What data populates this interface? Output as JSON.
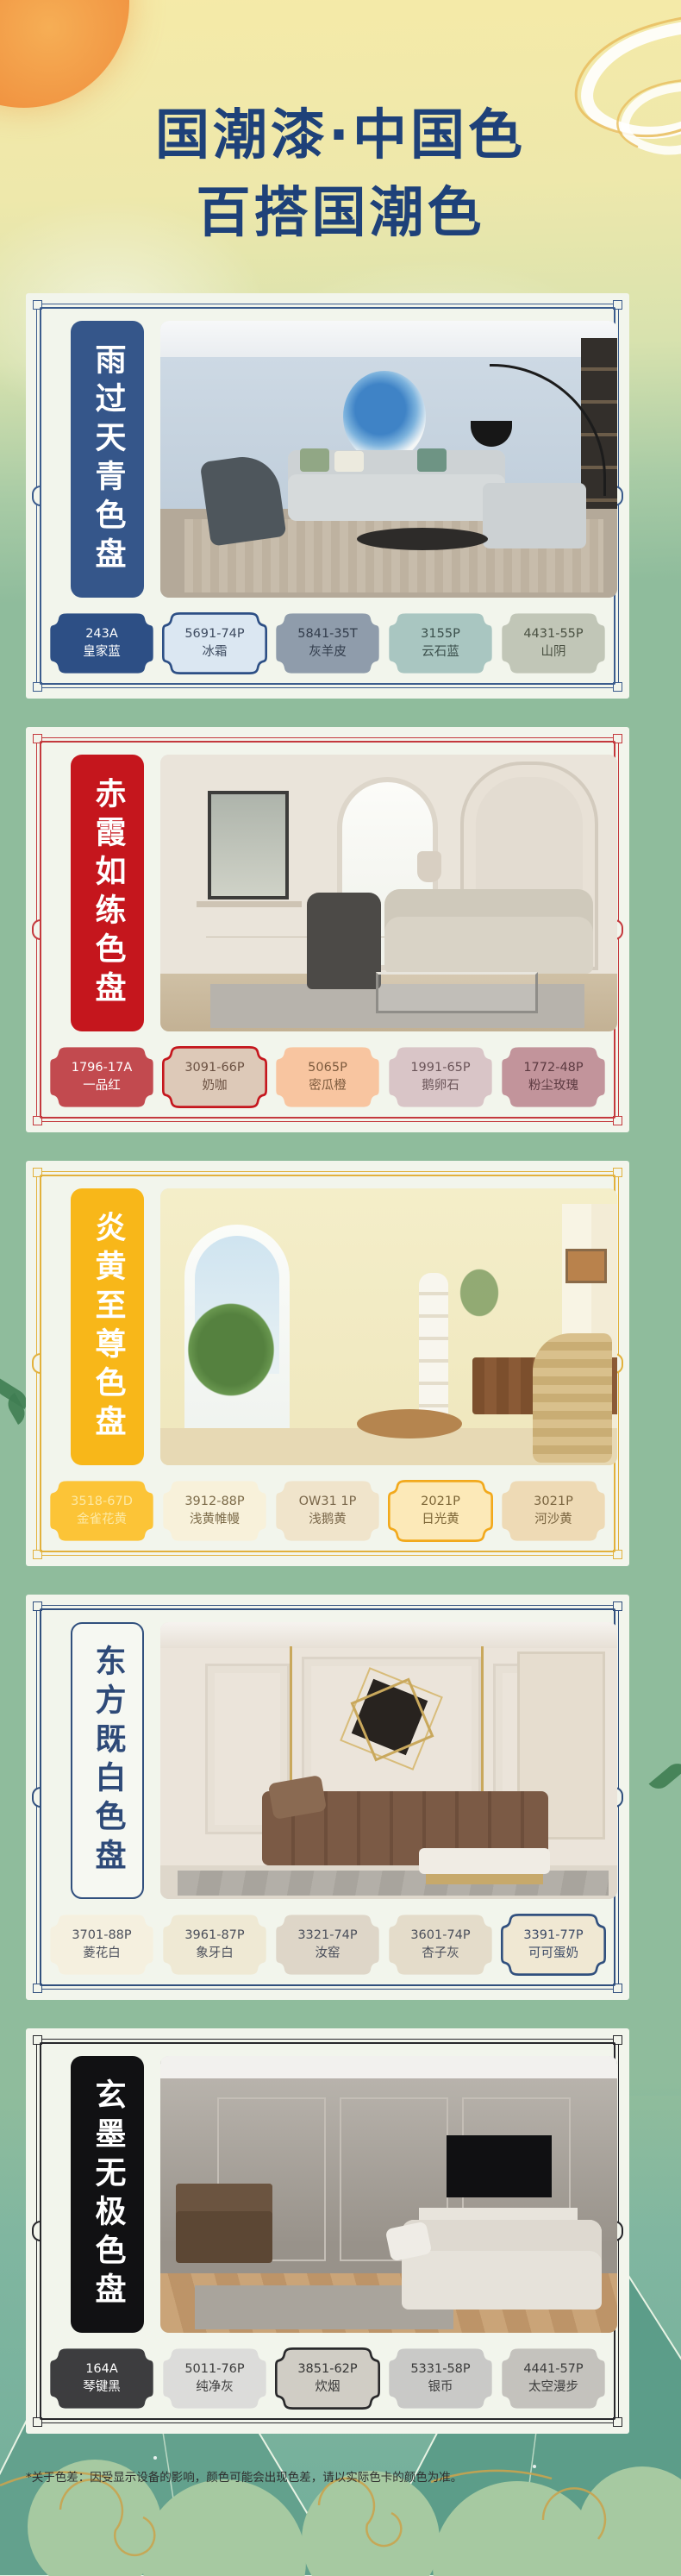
{
  "palette": {
    "page_green": "#8fbc9c",
    "bottom_teal": "#74b09c",
    "card_bg": "#f2f5ec",
    "title_color": "#1e4179",
    "footnote_color": "#2e2e2e",
    "sun_orange": "#f0913f",
    "cloud_gold": "#e9c063"
  },
  "header": {
    "title_line1": "国潮漆·中国色",
    "title_line2": "百搭国潮色"
  },
  "footer": {
    "note": "*关于色差：因受显示设备的影响，颜色可能会出现色差，请以实际色卡的颜色为准。"
  },
  "cards": [
    {
      "title": "雨过天青色盘",
      "theme": "#3b5c8d",
      "banner_bg": "#35568a",
      "banner_text": "#ffffff",
      "banner_border": "transparent",
      "swatches": [
        {
          "code": "243A",
          "name": "皇家蓝",
          "bg": "#2d4f85",
          "text": "#ffffff",
          "border": "transparent"
        },
        {
          "code": "5691-74P",
          "name": "冰霜",
          "bg": "#dbe7f2",
          "text": "#3f4c61",
          "border": "#2d4f85"
        },
        {
          "code": "5841-35T",
          "name": "灰羊皮",
          "bg": "#8f9cab",
          "text": "#323c4b",
          "border": "transparent"
        },
        {
          "code": "3155P",
          "name": "云石蓝",
          "bg": "#a9c6c1",
          "text": "#3b4f4b",
          "border": "transparent"
        },
        {
          "code": "4431-55P",
          "name": "山阴",
          "bg": "#c1c6b7",
          "text": "#4a5142",
          "border": "transparent"
        }
      ]
    },
    {
      "title": "赤霞如练色盘",
      "theme": "#c4393d",
      "banner_bg": "#c5161d",
      "banner_text": "#ffffff",
      "banner_border": "transparent",
      "swatches": [
        {
          "code": "1796-17A",
          "name": "一品红",
          "bg": "#c24a4f",
          "text": "#ffffff",
          "border": "transparent"
        },
        {
          "code": "3091-66P",
          "name": "奶咖",
          "bg": "#ddc9b8",
          "text": "#6b5142",
          "border": "#c5161d"
        },
        {
          "code": "5065P",
          "name": "密瓜橙",
          "bg": "#f8c5a0",
          "text": "#7d5b3e",
          "border": "transparent"
        },
        {
          "code": "1991-65P",
          "name": "鹅卵石",
          "bg": "#d9c5c7",
          "text": "#6a5458",
          "border": "transparent"
        },
        {
          "code": "1772-48P",
          "name": "粉尘玫瑰",
          "bg": "#c2949b",
          "text": "#5c3a41",
          "border": "transparent"
        }
      ]
    },
    {
      "title": "炎黄至尊色盘",
      "theme": "#e2b13c",
      "banner_bg": "#f8b719",
      "banner_text": "#ffffff",
      "banner_border": "transparent",
      "swatches": [
        {
          "code": "3518-67D",
          "name": "金雀花黄",
          "bg": "#fcc437",
          "text": "#fde9a4",
          "border": "transparent"
        },
        {
          "code": "3912-88P",
          "name": "浅黄帷幔",
          "bg": "#f8f1da",
          "text": "#7c6b49",
          "border": "transparent"
        },
        {
          "code": "OW31 1P",
          "name": "浅鹅黄",
          "bg": "#f0e4cb",
          "text": "#796649",
          "border": "transparent"
        },
        {
          "code": "2021P",
          "name": "日光黄",
          "bg": "#fce9b8",
          "text": "#7c6536",
          "border": "#f2a91c"
        },
        {
          "code": "3021P",
          "name": "河沙黄",
          "bg": "#eedab5",
          "text": "#79643f",
          "border": "transparent"
        }
      ]
    },
    {
      "title": "东方既白色盘",
      "theme": "#31507e",
      "banner_bg": "#f6f8f2",
      "banner_text": "#2e4a78",
      "banner_border": "#31507e",
      "swatches": [
        {
          "code": "3701-88P",
          "name": "菱花白",
          "bg": "#f5f0df",
          "text": "#4b4f5b",
          "border": "transparent"
        },
        {
          "code": "3961-87P",
          "name": "象牙白",
          "bg": "#efe9d4",
          "text": "#4b4f5b",
          "border": "transparent"
        },
        {
          "code": "3321-74P",
          "name": "汝窑",
          "bg": "#ded6c8",
          "text": "#4b4f5b",
          "border": "transparent"
        },
        {
          "code": "3601-74P",
          "name": "杏子灰",
          "bg": "#e4dcca",
          "text": "#4b4f5b",
          "border": "transparent"
        },
        {
          "code": "3391-77P",
          "name": "可可蛋奶",
          "bg": "#f0e8d3",
          "text": "#3c4a66",
          "border": "#31507e"
        }
      ]
    },
    {
      "title": "玄墨无极色盘",
      "theme": "#27272b",
      "banner_bg": "#111113",
      "banner_text": "#ffffff",
      "banner_border": "transparent",
      "swatches": [
        {
          "code": "164A",
          "name": "琴键黑",
          "bg": "#3d3d3f",
          "text": "#ffffff",
          "border": "transparent"
        },
        {
          "code": "5011-76P",
          "name": "纯净灰",
          "bg": "#dcdcda",
          "text": "#3c3c3c",
          "border": "transparent"
        },
        {
          "code": "3851-62P",
          "name": "炊烟",
          "bg": "#d0cdc5",
          "text": "#353535",
          "border": "#29292b"
        },
        {
          "code": "5331-58P",
          "name": "银币",
          "bg": "#c9c9c7",
          "text": "#3c3c3c",
          "border": "transparent"
        },
        {
          "code": "4441-57P",
          "name": "太空漫步",
          "bg": "#c4c2bd",
          "text": "#3c3c3c",
          "border": "transparent"
        }
      ]
    }
  ]
}
